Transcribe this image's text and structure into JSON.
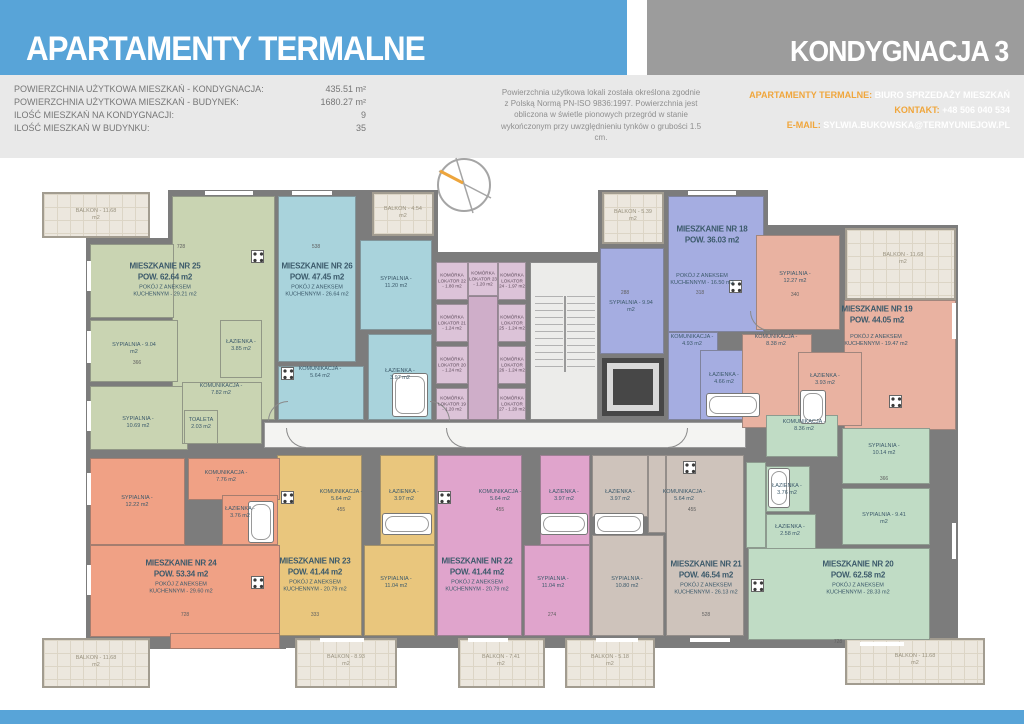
{
  "header": {
    "title": "APARTAMENTY TERMALNE",
    "floor": "KONDYGNACJA 3",
    "stats": [
      {
        "label": "POWIERZCHNIA UŻYTKOWA MIESZKAŃ - KONDYGNACJA:",
        "value": "435.51 m²"
      },
      {
        "label": "POWIERZCHNIA UŻYTKOWA MIESZKAŃ - BUDYNEK:",
        "value": "1680.27 m²"
      },
      {
        "label": "ILOŚĆ MIESZKAŃ NA KONDYGNACJI:",
        "value": "9"
      },
      {
        "label": "ILOŚĆ MIESZKAŃ W BUDYNKU:",
        "value": "35"
      }
    ],
    "note": "Powierzchnia użytkowa lokali została określona zgodnie z Polską Normą PN-ISO 9836:1997. Powierzchnia jest obliczona w świetle pionowych przegród w stanie wykończonym przy uwzględnieniu tynków o grubości 1.5 cm.",
    "contact": {
      "office_label": "APARTAMENTY TERMALNE:",
      "office": "BIURO SPRZEDAŻY MIESZKAŃ",
      "phone_label": "KONTAKT:",
      "phone": "+48 506 040 534",
      "email_label": "E-MAIL:",
      "email": "SYLWIA.BUKOWSKA@TERMYUNIEJOW.PL"
    },
    "colors": {
      "accent_blue": "#58a4d8",
      "accent_gray": "#9c9c9c",
      "accent_orange": "#f0a63c"
    }
  },
  "plan": {
    "apartments": {
      "a18": {
        "name": "MIESZKANIE NR 18",
        "area": "POW. 36.03 m2",
        "unit": "POKÓJ Z ANEKSEM KUCHENNYM - 16.50 m2",
        "rooms": {
          "s1": "SYPIALNIA - 9.94 m2",
          "kom": "KOMUNIKACJA - 4.93 m2",
          "laz": "ŁAZIENKA - 4.66 m2"
        }
      },
      "a19": {
        "name": "MIESZKANIE NR 19",
        "area": "POW. 44.05 m2",
        "unit": "POKÓJ Z ANEKSEM KUCHENNYM - 19.47 m2",
        "rooms": {
          "s1": "SYPIALNIA - 12.27 m2",
          "kom": "KOMUNIKACJA - 8.38 m2",
          "laz": "ŁAZIENKA - 3.93 m2"
        }
      },
      "a20": {
        "name": "MIESZKANIE NR 20",
        "area": "POW. 62.58 m2",
        "unit": "POKÓJ Z ANEKSEM KUCHENNYM - 28.33 m2",
        "rooms": {
          "kom": "KOMUNIKACJA - 8.36 m2",
          "s1": "SYPIALNIA - 10.14 m2",
          "s2": "SYPIALNIA - 9.41 m2",
          "laz1": "ŁAZIENKA - 3.76 m2",
          "laz2": "ŁAZIENKA - 2.58 m2"
        }
      },
      "a21": {
        "name": "MIESZKANIE NR 21",
        "area": "POW. 46.54 m2",
        "unit": "POKÓJ Z ANEKSEM KUCHENNYM - 26.13 m2",
        "rooms": {
          "kom": "KOMUNIKACJA - 5.64 m2",
          "laz": "ŁAZIENKA - 3.97 m2",
          "s1": "SYPIALNIA - 10.80 m2"
        }
      },
      "a22": {
        "name": "MIESZKANIE NR 22",
        "area": "POW. 41.44 m2",
        "unit": "POKÓJ Z ANEKSEM KUCHENNYM - 20.79 m2",
        "rooms": {
          "kom": "KOMUNIKACJA - 5.64 m2",
          "laz": "ŁAZIENKA - 3.97 m2",
          "s1": "SYPIALNIA - 11.04 m2"
        }
      },
      "a23": {
        "name": "MIESZKANIE NR 23",
        "area": "POW. 41.44 m2",
        "unit": "POKÓJ Z ANEKSEM KUCHENNYM - 20.79 m2",
        "rooms": {
          "kom": "KOMUNIKACJA - 5.64 m2",
          "laz": "ŁAZIENKA - 3.97 m2",
          "s1": "SYPIALNIA - 11.04 m2"
        }
      },
      "a24": {
        "name": "MIESZKANIE NR 24",
        "area": "POW. 53.34 m2",
        "unit": "POKÓJ Z ANEKSEM KUCHENNYM - 29.60 m2",
        "rooms": {
          "s1": "SYPIALNIA - 12.22 m2",
          "kom": "KOMUNIKACJA - 7.76 m2",
          "laz": "ŁAZIENKA - 3.76 m2"
        }
      },
      "a25": {
        "name": "MIESZKANIE NR 25",
        "area": "POW. 62.64 m2",
        "unit": "POKÓJ Z ANEKSEM KUCHENNYM - 29.21 m2",
        "rooms": {
          "s1": "SYPIALNIA - 9.04 m2",
          "s2": "SYPIALNIA - 10.69 m2",
          "laz": "ŁAZIENKA - 3.85 m2",
          "kom": "KOMUNIKACJA - 7.82 m2",
          "toa": "TOALETA 2.03 m2"
        }
      },
      "a26": {
        "name": "MIESZKANIE NR 26",
        "area": "POW. 47.45 m2",
        "unit": "POKÓJ Z ANEKSEM KUCHENNYM - 26.64 m2",
        "rooms": {
          "s1": "SYPIALNIA - 11.20 m2",
          "laz": "ŁAZIENKA - 3.97 m2",
          "kom": "KOMUNIKACJA - 5.64 m2"
        }
      }
    },
    "balconies": {
      "b1": "BALKON - 11.68 m2",
      "b2": "BALKON - 4.54 m2",
      "b3": "BALKON - 5.39 m2",
      "b4": "BALKON - 11.68 m2",
      "b5": "BALKON - 11.68 m2",
      "b6": "BALKON - 8.93 m2",
      "b7": "BALKON - 7.41 m2",
      "b8": "BALKON - 5.18 m2",
      "b9": "BALKON - 11.68 m2"
    },
    "storage": {
      "k22": "KOMÓRKA LOKATOR 22 - 1.80 m2",
      "k23": "KOMÓRKA LOKATOR 23 - 1.20 m2",
      "k24": "KOMÓRKA LOKATOR 24 - 1.97 m2",
      "k21": "KOMÓRKA LOKATOR 21 - 1.24 m2",
      "k25": "KOMÓRKA LOKATOR 25 - 1.24 m2",
      "k20": "KOMÓRKA LOKATOR 20 - 1.24 m2",
      "k26": "KOMÓRKA LOKATOR 26 - 1.24 m2",
      "k19": "KOMÓRKA LOKATOR 19 - 1.20 m2",
      "k27": "KOMÓRKA LOKATOR 27 - 1.20 m2"
    },
    "dims": {
      "d1": "728",
      "d2": "538",
      "d3": "366",
      "d4": "288",
      "d5": "318",
      "d6": "340",
      "d7": "366",
      "d8": "455",
      "d9": "455",
      "d10": "455",
      "d11": "333",
      "d12": "274",
      "d13": "528",
      "d14": "728",
      "d15": "728"
    }
  }
}
